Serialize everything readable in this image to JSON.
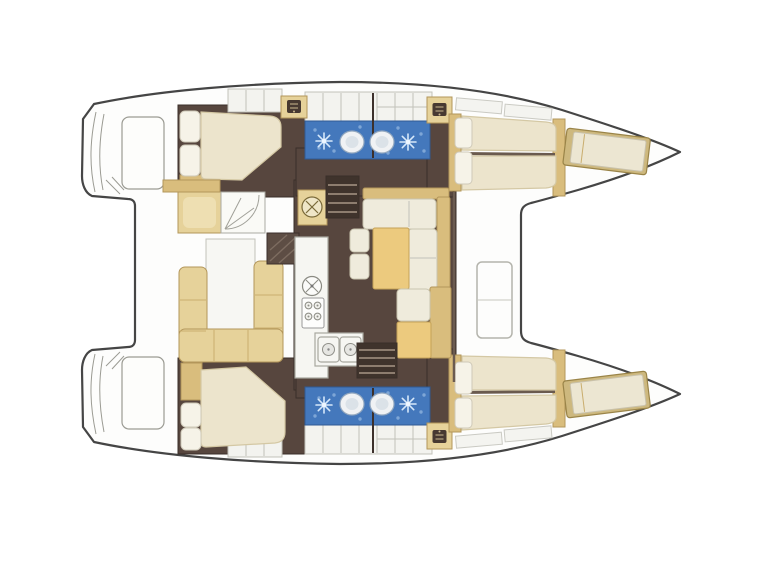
{
  "page": {
    "background": "#ffffff",
    "aria_label": "Catamaran interior layout floor plan, top-down view, bow facing right"
  },
  "colors": {
    "background": "#ffffff",
    "hull_line": "#454545",
    "deck": "#fdfdfc",
    "floor_dark": "#57463e",
    "steps_dark": "#3f332c",
    "wall_dark": "#3a2f29",
    "tan": "#e6d29a",
    "tan_dark": "#d9bd7d",
    "tan_border": "#b3965a",
    "table_tan": "#ecca7e",
    "mattress": "#ece4cc",
    "mattress_border": "#d4c8a4",
    "cushion": "#efebdc",
    "cushion_border": "#c9c4af",
    "pillow": "#f6f3e8",
    "counter": "#f6f6f2",
    "counter_border": "#a8a8a0",
    "tile": "#f3f3ef",
    "tile_border": "#c2c2ba",
    "shower_blue": "#4478bc",
    "shower_blue_border": "#2f5a94",
    "shower_speckle": "#7ea6d6",
    "fixture_white": "#f0f2f4",
    "fixture_border": "#93a8bf",
    "glyph_dark": "#473931"
  },
  "plan": {
    "type": "boat-floor-plan",
    "orientation": "bow-right",
    "hulls": [
      {
        "id": "port-hull",
        "position": "top",
        "rooms": [
          "transom-steps",
          "aft-double-cabin",
          "aft-head-with-shower-and-toilet",
          "forward-head-with-shower-and-toilet",
          "forward-v-berth-cabin",
          "forepeak-berth"
        ]
      },
      {
        "id": "starboard-hull",
        "position": "bottom",
        "rooms": [
          "transom-steps",
          "aft-double-cabin",
          "aft-head-with-shower-and-toilet",
          "forward-head-with-shower-and-toilet",
          "forward-v-berth-cabin",
          "forepeak-berth"
        ]
      }
    ],
    "bridge_deck": {
      "aft": "cockpit with U-shaped bench seating, table and helm seat",
      "center": "salon with galley and L-shaped dinette with table and stools",
      "forward": "foredeck with locker hatch and open trampoline area"
    },
    "galley_equipment": [
      "round-sink-hatch",
      "four-burner-stove",
      "double-sink"
    ],
    "head_fixtures": [
      "shower-head",
      "toilet",
      "vanity-cabinet"
    ],
    "stairways": [
      "companionway-to-port-hull",
      "companionway-to-starboard-hull"
    ]
  }
}
